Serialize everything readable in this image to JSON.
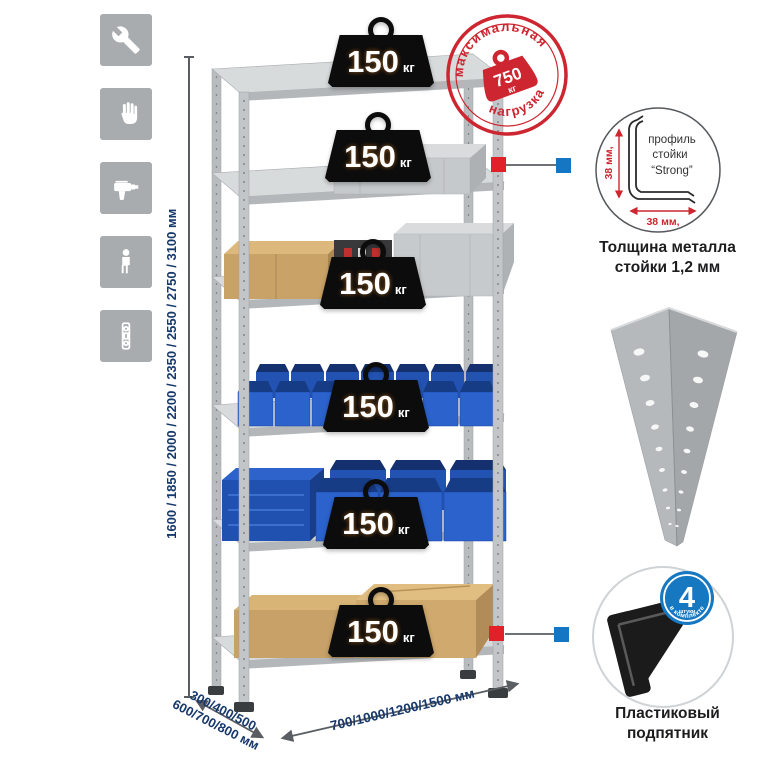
{
  "colors": {
    "accent_red": "#cd2630",
    "accent_blue": "#1576c4",
    "navy_dim_text": "#16386b",
    "tile_gray": "#a8acaf",
    "metal_light": "#d8dbdc",
    "metal_mid": "#b6babd",
    "bin_blue": "#2b62cc",
    "cardboard_tan": "#c9a267",
    "badge_black": "#0c0c0c"
  },
  "sidebar": {
    "icons": [
      "wrench",
      "gloves",
      "drill",
      "person",
      "mounting-strip"
    ]
  },
  "dimensions": {
    "height": "1600 / 1850 / 2000 / 2200 / 2350 / 2550 / 2750 / 3100 мм",
    "depth_line1": "300/400/500",
    "depth_line2": "600/700/800 мм",
    "width": "700/1000/1200/1500 мм"
  },
  "shelves": {
    "loads": [
      {
        "value": "150",
        "unit": "кг"
      },
      {
        "value": "150",
        "unit": "кг"
      },
      {
        "value": "150",
        "unit": "кг"
      },
      {
        "value": "150",
        "unit": "кг"
      },
      {
        "value": "150",
        "unit": "кг"
      },
      {
        "value": "150",
        "unit": "кг"
      }
    ]
  },
  "stamp": {
    "arc_top": "максимальная",
    "arc_bottom": "нагрузка",
    "value": "750",
    "unit": "кг"
  },
  "profile_detail": {
    "label_line1": "профиль",
    "label_line2": "стойки",
    "label_line3": "“Strong”",
    "dim_vertical": "38 мм,",
    "dim_horizontal": "38 мм,",
    "caption_line1": "Толщина металла",
    "caption_line2": "стойки 1,2 мм"
  },
  "foot_detail": {
    "badge_value": "4",
    "badge_sub": "штуки",
    "badge_arc": "в комплекте",
    "caption_line1": "Пластиковый",
    "caption_line2": "подпятник"
  }
}
